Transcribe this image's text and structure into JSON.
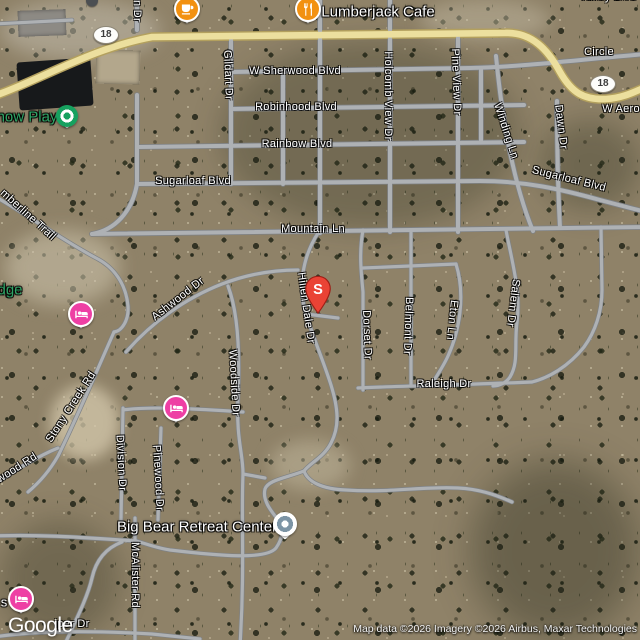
{
  "logo": {
    "text": "Google"
  },
  "attribution": {
    "text": "Map data ©2026 Imagery ©2026 Airbus, Maxar Technologies"
  },
  "colors": {
    "restaurant_marker": "#F29111",
    "lodging_marker": "#EE3FA4",
    "park_marker": "#16A15F",
    "place_marker_ring": "#7C94A5",
    "search_pin": "#EA4335",
    "highway": "#ECDF9E",
    "road": "#AEB1B4",
    "green_label": "#2EA566"
  },
  "shields": [
    {
      "text": "18",
      "x": 106,
      "y": 35
    },
    {
      "text": "18",
      "x": 603,
      "y": 84
    }
  ],
  "road_labels": [
    {
      "text": "W Sherwood Blvd",
      "x": 295,
      "y": 71
    },
    {
      "text": "Robinhood Blvd",
      "x": 296,
      "y": 107
    },
    {
      "text": "Rainbow Blvd",
      "x": 297,
      "y": 144
    },
    {
      "text": "Sugarloaf Blvd",
      "x": 193,
      "y": 181
    },
    {
      "text": "Sugarloaf Blvd",
      "x": 569,
      "y": 179,
      "rot": 14
    },
    {
      "text": "Mountain Ln",
      "x": 313,
      "y": 229
    },
    {
      "text": "Raleigh Dr",
      "x": 444,
      "y": 384
    },
    {
      "text": "Gildart Dr",
      "x": 228,
      "y": 75,
      "rot": 88
    },
    {
      "text": "Holcomb View Dr",
      "x": 388,
      "y": 96,
      "rot": 90
    },
    {
      "text": "Pine View Dr",
      "x": 456,
      "y": 82,
      "rot": 88
    },
    {
      "text": "Winding Ln",
      "x": 506,
      "y": 131,
      "rot": 72
    },
    {
      "text": "Dawn Dr",
      "x": 561,
      "y": 127,
      "rot": 83
    },
    {
      "text": "W Aero",
      "x": 621,
      "y": 109
    },
    {
      "text": "Circle",
      "x": 599,
      "y": 52
    },
    {
      "text": "Valley Blvd",
      "x": 608,
      "y": -3
    },
    {
      "text": "n Dr",
      "x": 137,
      "y": 11,
      "rot": 90
    },
    {
      "text": "mberline Trail",
      "x": 28,
      "y": 215,
      "rot": 42
    },
    {
      "text": "Ashwood Dr",
      "x": 178,
      "y": 299,
      "rot": -38
    },
    {
      "text": "Hillen Dale Dr",
      "x": 306,
      "y": 308,
      "rot": 82
    },
    {
      "text": "Dorset Dr",
      "x": 367,
      "y": 335,
      "rot": 88
    },
    {
      "text": "Belmont Dr",
      "x": 408,
      "y": 326,
      "rot": 92
    },
    {
      "text": "Eton Ln",
      "x": 452,
      "y": 320,
      "rot": 96
    },
    {
      "text": "Salem Dr",
      "x": 513,
      "y": 303,
      "rot": 97
    },
    {
      "text": "Stony Creek Rd",
      "x": 71,
      "y": 407,
      "rot": -57
    },
    {
      "text": "wood Rd",
      "x": 17,
      "y": 468,
      "rot": -33
    },
    {
      "text": "Woodside Dr",
      "x": 234,
      "y": 383,
      "rot": 87
    },
    {
      "text": "Division Dr",
      "x": 121,
      "y": 463,
      "rot": 87
    },
    {
      "text": "Pinewood Dr",
      "x": 158,
      "y": 478,
      "rot": 87
    },
    {
      "text": "McAlister Rd",
      "x": 135,
      "y": 575,
      "rot": 90
    },
    {
      "text": "iper Dr",
      "x": 72,
      "y": 624
    }
  ],
  "poi_labels": [
    {
      "text": "Lumberjack Cafe",
      "x": 378,
      "y": 12,
      "color": "white"
    },
    {
      "text": "Big Bear Retreat Center",
      "x": 197,
      "y": 527,
      "color": "white"
    },
    {
      "text": "now Play",
      "x": 27,
      "y": 117,
      "color": "green"
    },
    {
      "text": "dge",
      "x": 10,
      "y": 290,
      "color": "green"
    },
    {
      "text": "s",
      "x": 4,
      "y": 602,
      "color": "white",
      "size": 13
    }
  ],
  "markers": [
    {
      "type": "cafe",
      "x": 187,
      "y": 9
    },
    {
      "type": "restaurant",
      "x": 308,
      "y": 9
    },
    {
      "type": "lodging",
      "x": 81,
      "y": 314
    },
    {
      "type": "lodging",
      "x": 176,
      "y": 408
    },
    {
      "type": "lodging",
      "x": 21,
      "y": 599
    },
    {
      "type": "park",
      "x": 67,
      "y": 116
    },
    {
      "type": "place",
      "x": 285,
      "y": 524
    },
    {
      "type": "pin",
      "x": 318,
      "y": 303,
      "label": "S"
    },
    {
      "type": "pin-tip",
      "x": 92,
      "y": 2
    }
  ]
}
